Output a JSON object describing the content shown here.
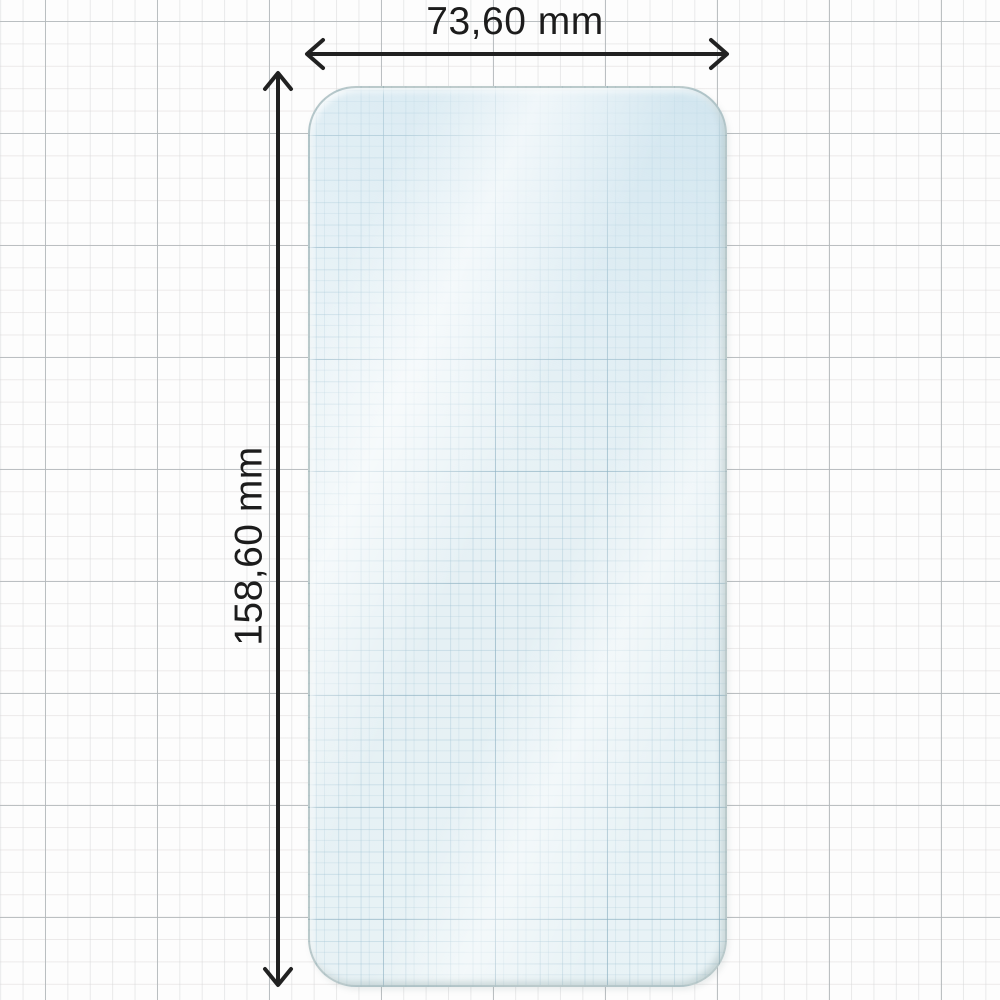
{
  "diagram": {
    "subject": "phone screen protector on graph paper",
    "width_label": "73,60 mm",
    "height_label": "158,60 mm"
  },
  "icons": {
    "width_arrow": "horizontal double-headed dimension arrow",
    "height_arrow": "vertical double-headed dimension arrow"
  },
  "colors": {
    "page_background": "#fdfdfd",
    "grid_minor": "#dbd7d7",
    "grid_major": "#b2b7ba",
    "glass_tint": "#e9f3f6",
    "glass_grid_line": "#8aadbe",
    "glass_border": "#94a7a7",
    "dimension_line": "#212121",
    "label_text": "#1c1c1c"
  }
}
